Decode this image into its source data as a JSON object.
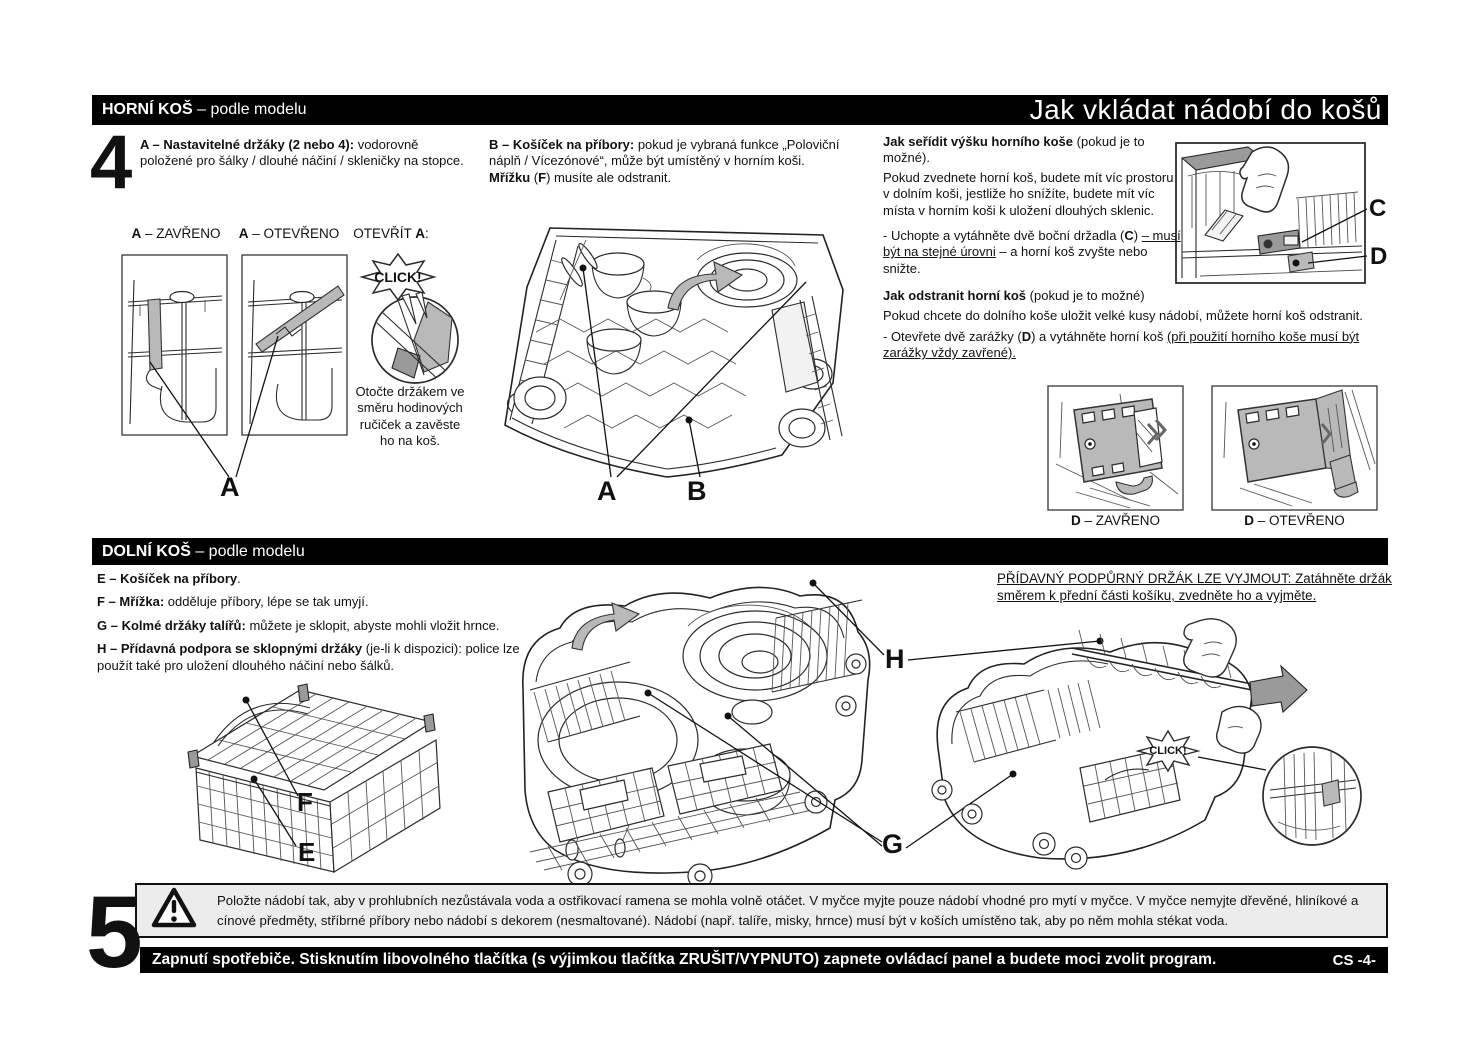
{
  "header": {
    "section": {
      "bold": "HORNÍ KOŠ",
      "rest": " – podle modelu"
    },
    "title": "Jak vkládat nádobí do košů"
  },
  "steps": {
    "four": "4",
    "five": "5"
  },
  "upper": {
    "item_a": {
      "bold": "A – Nastavitelné držáky (2 nebo 4):",
      "rest": " vodorovně položené pro šálky / dlouhé náčiní / skleničky na stopce."
    },
    "item_b": {
      "bold": "B – Košíček na příbory:",
      "rest": " pokud je vybraná funkce „Poloviční náplň / Vícezónové“, může být umístěný v horním koši. ",
      "bold2": "Mřížku",
      "rest2": " (",
      "bold3": "F",
      "rest3": ") musíte ale odstranit."
    },
    "captions": {
      "a_closed": {
        "bold": "A",
        "rest": " – ZAVŘENO"
      },
      "a_open": {
        "bold": "A",
        "rest": " – OTEVŘENO"
      },
      "open_a": {
        "pre": "OTEVŘÍT ",
        "bold": "A",
        "post": ":"
      }
    },
    "click": "CLICK!",
    "rotate_note": "Otočte držákem ve směru hodinových ručiček a zavěste ho na koš.",
    "label_a": "A",
    "label_b": "B",
    "label_c": "C",
    "label_d": "D",
    "adjust": {
      "heading_bold": "Jak seřídit výšku horního koše",
      "heading_rest": " (pokud je to možné).",
      "p1": "Pokud zvednete horní koš, budete mít víc prostoru v dolním koši, jestliže ho snížíte, budete mít víc místa v horním koši k uložení dlouhých sklenic.",
      "p2_pre": "- Uchopte a vytáhněte dvě boční držadla (",
      "p2_bold": "C",
      "p2_mid": ") ",
      "p2_underline": "– musí být na stejné úrovni",
      "p2_post": " – a horní koš zvyšte nebo snižte."
    },
    "remove": {
      "heading_bold": "Jak odstranit horní koš",
      "heading_rest": " (pokud je to možné)",
      "p1": "Pokud chcete do dolního koše uložit velké kusy nádobí, můžete horní koš odstranit.",
      "p2_pre": "- Otevřete dvě zarážky (",
      "p2_bold": "D",
      "p2_mid": ") a vytáhněte horní koš ",
      "p2_underline": "(při použití horního koše musí být zarážky vždy zavřené)."
    },
    "d_captions": {
      "closed": {
        "bold": "D",
        "rest": " – ZAVŘENO"
      },
      "open": {
        "bold": "D",
        "rest": " – OTEVŘENO"
      }
    }
  },
  "lower": {
    "section": {
      "bold": "DOLNÍ KOŠ",
      "rest": " – podle modelu"
    },
    "item_e": {
      "bold": "E – Košíček na příbory",
      "rest": "."
    },
    "item_f": {
      "bold": "F – Mřížka:",
      "rest": " odděluje příbory, lépe se tak umyjí."
    },
    "item_g": {
      "bold": "G – Kolmé držáky talířů:",
      "rest": " můžete je sklopit, abyste mohli vložit hrnce."
    },
    "item_h": {
      "bold": "H – Přídavná podpora se sklopnými držáky",
      "rest": " (je-li k dispozici): police lze použít také pro uložení dlouhého náčiní nebo šálků."
    },
    "removable_note": "PŘÍDAVNÝ PODPŮRNÝ DRŽÁK LZE VYJMOUT: Zatáhněte držák směrem k přední části košíku, zvedněte ho a vyjměte.",
    "labels": {
      "e": "E",
      "f": "F",
      "g": "G",
      "h": "H"
    },
    "click": "CLICK!"
  },
  "warning": {
    "text": "Položte nádobí tak, aby v prohlubních nezůstávala voda a ostřikovací ramena se mohla volně otáčet. V myčce myjte pouze nádobí vhodné pro mytí v myčce. V myčce nemyjte dřevěné, hliníkové a cínové předměty, stříbrné příbory nebo nádobí s dekorem (nesmaltované). Nádobí (např. talíře, misky, hrnce) musí být v koších umístěno tak, aby po něm mohla stékat voda."
  },
  "footer": {
    "text": "Zapnutí spotřebiče. Stisknutím libovolného tlačítka (s výjimkou tlačítka ZRUŠIT/VYPNUTO) zapnete ovládací panel a budete moci zvolit program.",
    "page": "CS -4-"
  },
  "colors": {
    "bar": "#000000",
    "warning_bg": "#ececec",
    "gray_fill": "#b9b9b9"
  }
}
